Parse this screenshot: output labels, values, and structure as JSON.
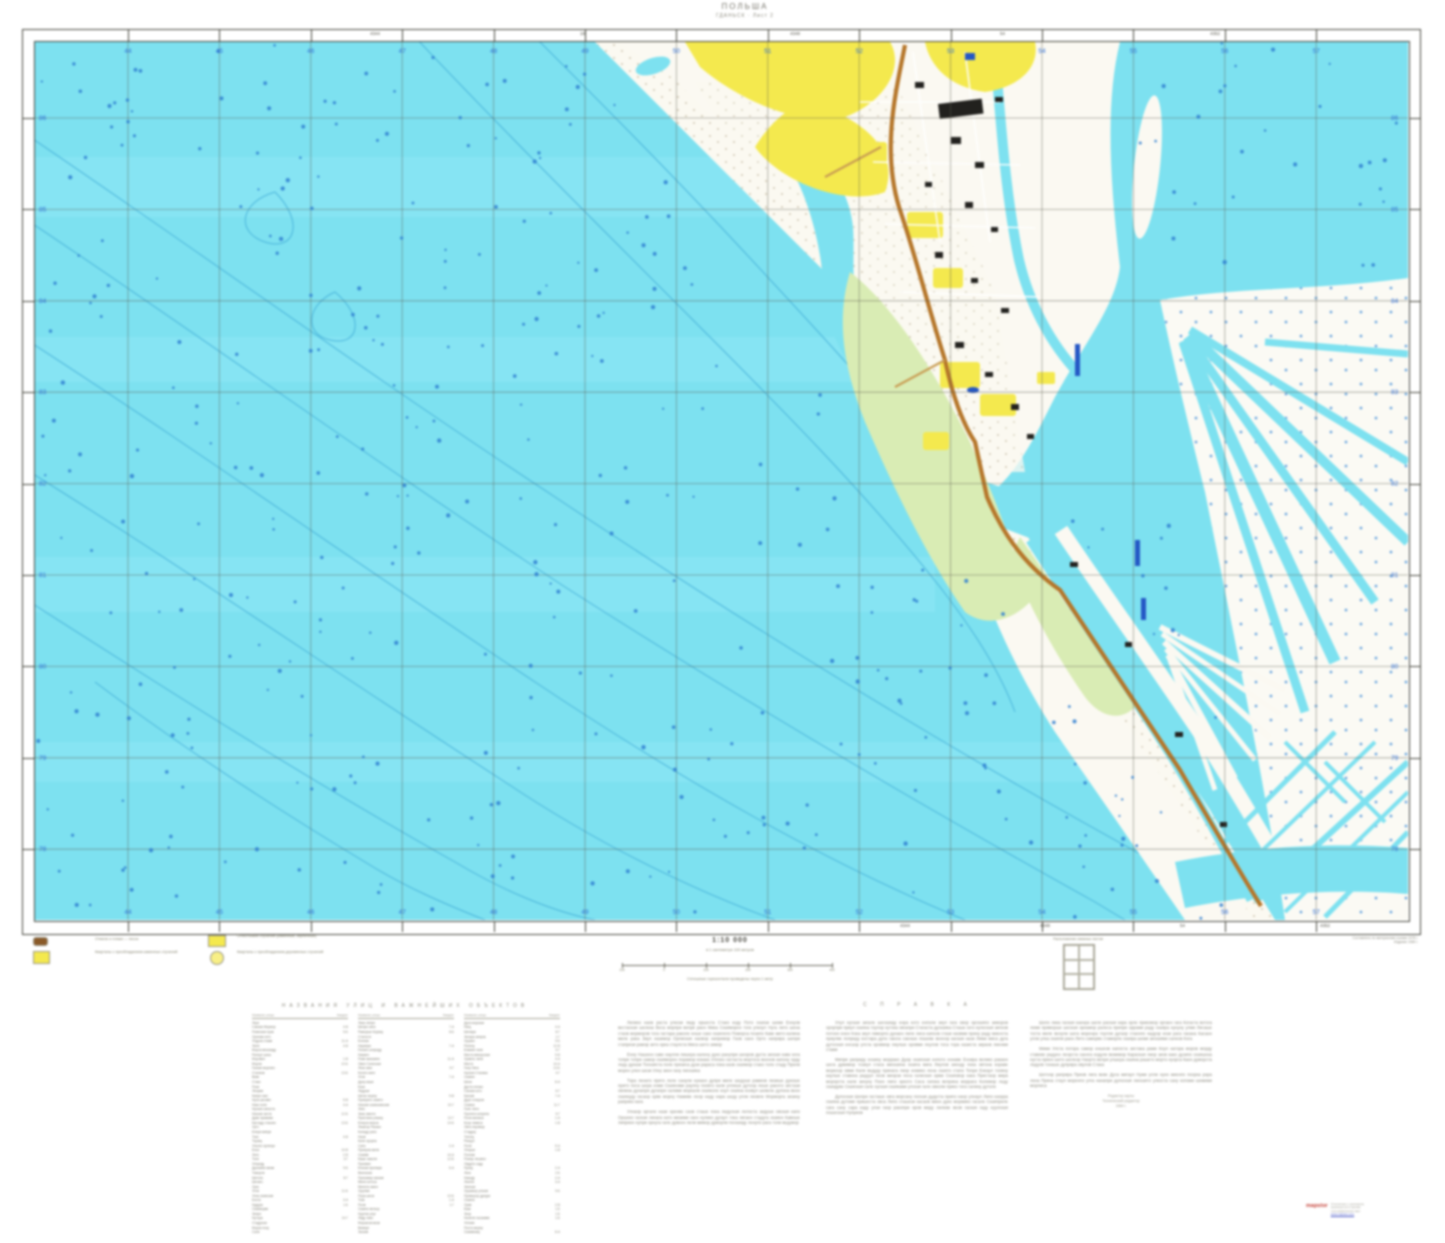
{
  "colors": {
    "sea": "#7DE1F0",
    "sea_light": "#93E9F6",
    "land": "#FBF9F2",
    "green": "#D9ECB4",
    "yellow": "#F4E94E",
    "road": "#B5762A",
    "contour": "#3FAAD6",
    "depth_dot": "#2F7FD0",
    "dark_blue": "#2457C5",
    "grid": "#5c5c50",
    "building": "#22211e",
    "blue_label": "#2F6FD8"
  },
  "sheet": {
    "title1": "ПОЛЬША",
    "title2": "ГДАНЬСК · Лист 2"
  },
  "frame": {
    "grid_labels_x": [
      "44",
      "45",
      "46",
      "47",
      "48",
      "49",
      "50",
      "51",
      "52",
      "53",
      "54",
      "55",
      "56",
      "57"
    ],
    "grid_labels_y": [
      "86",
      "85",
      "84",
      "83",
      "82",
      "81",
      "80",
      "79",
      "78"
    ],
    "top_numbers": [
      "4344",
      "18",
      "4348",
      "54",
      "4352"
    ],
    "bottom_numbers": [
      "4344",
      "4348",
      "54",
      "4352"
    ]
  },
  "legend": {
    "items": [
      {
        "label": "Отмели и пляжи — песок"
      },
      {
        "label": "Кварталы с преобладанием каменных строений"
      },
      {
        "label": "Огнестойкие строения (каменные, кирпичные)"
      },
      {
        "label": "Кварталы с преобладанием деревянных строений"
      }
    ]
  },
  "scale": {
    "ratio": "1:10 000",
    "sub": "в 1 сантиметре 100 метров",
    "bar_labels": [
      "100",
      "0",
      "100",
      "200",
      "300",
      "400"
    ],
    "note": "Сплошные горизонтали проведены через 1 метр"
  },
  "index_diagram": {
    "label": "Расположение смежных листов"
  },
  "credits": {
    "line1": "Составлено по материалам съемки 1978 г.",
    "line2": "Издание 1984 г."
  },
  "index_table": {
    "title": "НАЗВАНИЯ УЛИЦ И ВАЖНЕЙШИХ ОБЪЕКТОВ",
    "col_name": "Название улицы",
    "col_num": "Квадрат",
    "pair_lefts": [
      252,
      358,
      464
    ],
    "rows_per_pair": 47
  },
  "reference": {
    "title": "С П Р А В К А",
    "col_lefts": [
      618,
      826,
      1030
    ],
    "col_paragraphs": [
      [
        58,
        46,
        52,
        38
      ],
      [
        64,
        72,
        40
      ],
      [
        50,
        42,
        26
      ]
    ],
    "footer_lines": [
      "Редактор карты",
      "Технический редактор",
      "1984 г."
    ]
  },
  "stamp": {
    "red": "mapstor",
    "lines": [
      "Отпечатано с оригинала,",
      "хранящегося в архиве",
      "топографических карт"
    ],
    "link": "www.mapstor.com"
  },
  "map_grid": {
    "x0": 93,
    "dx": 91.4,
    "nx": 14,
    "y0": 76,
    "dy": 91.4,
    "ny": 9
  }
}
